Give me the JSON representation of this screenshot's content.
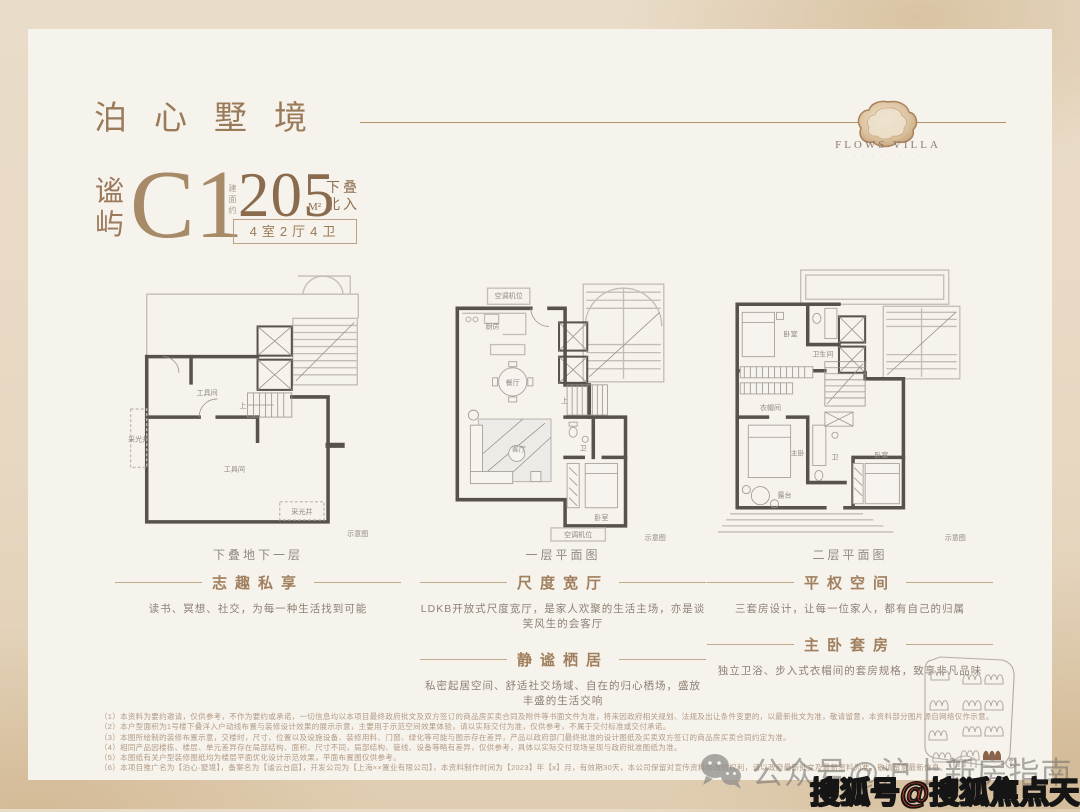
{
  "theme": {
    "outer_bg": "#e7d8c2",
    "card_bg": "#f6f2ec",
    "accent_brown": "#9a7a5a",
    "number_brown": "#8a6b4e",
    "heading_brown": "#a0805f",
    "caption_gray": "#8f8a84",
    "plan_wall_dark": "#57524c",
    "plan_wall_light": "#c3bdb4",
    "map_highlight": "#8a6348",
    "sohu_red": "#d23b25",
    "watermark_gray": "#767470"
  },
  "header": {
    "title": "泊心墅境",
    "brand": "FLOWS VILLA",
    "brand_sub": "· · · · · · · ·"
  },
  "unit": {
    "name_chars": [
      "谧",
      "屿"
    ],
    "model": "C1",
    "area_label": "建面约",
    "area": "205",
    "area_unit": "M²",
    "tag1": "下叠",
    "tag2": "北入",
    "layout": "4室2厅4卫"
  },
  "columns": {
    "c1": {
      "caption": "下叠地下一层",
      "h1": "志趣私享",
      "b1": "读书、冥想、社交，为每一种生活找到可能"
    },
    "c2": {
      "caption": "一层平面图",
      "h1": "尺度宽厅",
      "b1": "LDKB开放式尺度宽厅，是家人欢聚的生活主场，亦是谈笑风生的会客厅",
      "h2": "静谧栖居",
      "b2": "私密起居空间、舒适社交场域、自在的归心栖场，盛放丰盛的生活交响"
    },
    "c3": {
      "caption": "二层平面图",
      "h1": "平权空间",
      "b1": "三套房设计，让每一位家人，都有自己的归属",
      "h2": "主卧套房",
      "b2": "独立卫浴、步入式衣帽间的套房规格，致享非凡品味"
    }
  },
  "plans": {
    "p1": {
      "rooms": {
        "r1": "工具间",
        "r2": "工具间",
        "well_left": "采光井",
        "well_bottom": "采光井",
        "stairs": "上"
      },
      "note": "示意图"
    },
    "p2": {
      "rooms": {
        "kitchen": "厨房",
        "dining": "餐厅",
        "living": "客厅",
        "bedroom": "卧室",
        "bath": "卫",
        "stairs": "上",
        "ac_top": "空调机位",
        "ac_bottom": "空调机位"
      },
      "note": "示意图"
    },
    "p3": {
      "rooms": {
        "bed1": "卧室",
        "bath1": "卫生间",
        "closet": "衣帽间",
        "master": "主卧",
        "bath2": "卫",
        "bed2": "卧室",
        "terrace": "露台"
      },
      "note": "示意图"
    }
  },
  "disclaimers": [
    "（1）本资料为要约邀请，仅供参考，不作为要约或承诺，一切信息均以本项目最终政府批文及双方签订的商品房买卖合同及附件等书面文件为准，将来因政府相关规划、法规及出让条件变更的，以最新批文为准，敬请留意，本资料部分图片源自网络仅作示意。",
    "（2）本户型面积为1号楼下叠洋入户动线布置与装修设计效果的展示示意，主要用于示范空间效果体验，请以实际交付为准，仅供参考，不属于交付标准或交付承诺。",
    "（3）本图所绘制的装修布置示意，交楼时，尺寸、位置以及设施设备、装修用料、门窗、绿化等可能与图示存在差异，产品以政府部门最终批准的设计图纸及买卖双方签订的商品房买卖合同约定为准。",
    "（4）相同产品因楼栋、楼层、单元差异存在局部结构、面积、尺寸不同，局部结构、管线、设备等略有差异，仅供参考，具体以实际交付现场呈现与政府批准图纸为准。",
    "（5）本图纸有关户型装修图纸均为楼层平面优化设计示范效果，平面布置图仅供参考。",
    "（6）本项目推广名为【泊心·墅境】，备案名为【谧云台庭】，开发公司为【上海××置业有限公司】，本资料制作时间为【2023】年【x】月，有效期30天，本公司保留对宣传资料修改的权利，请以政府最新批文及最新资料为准，敬请留意最新信息。"
  ],
  "watermarks": {
    "wechat": "公众号@沪上新房指南",
    "sohu": "搜狐号@搜狐焦点天门站"
  }
}
